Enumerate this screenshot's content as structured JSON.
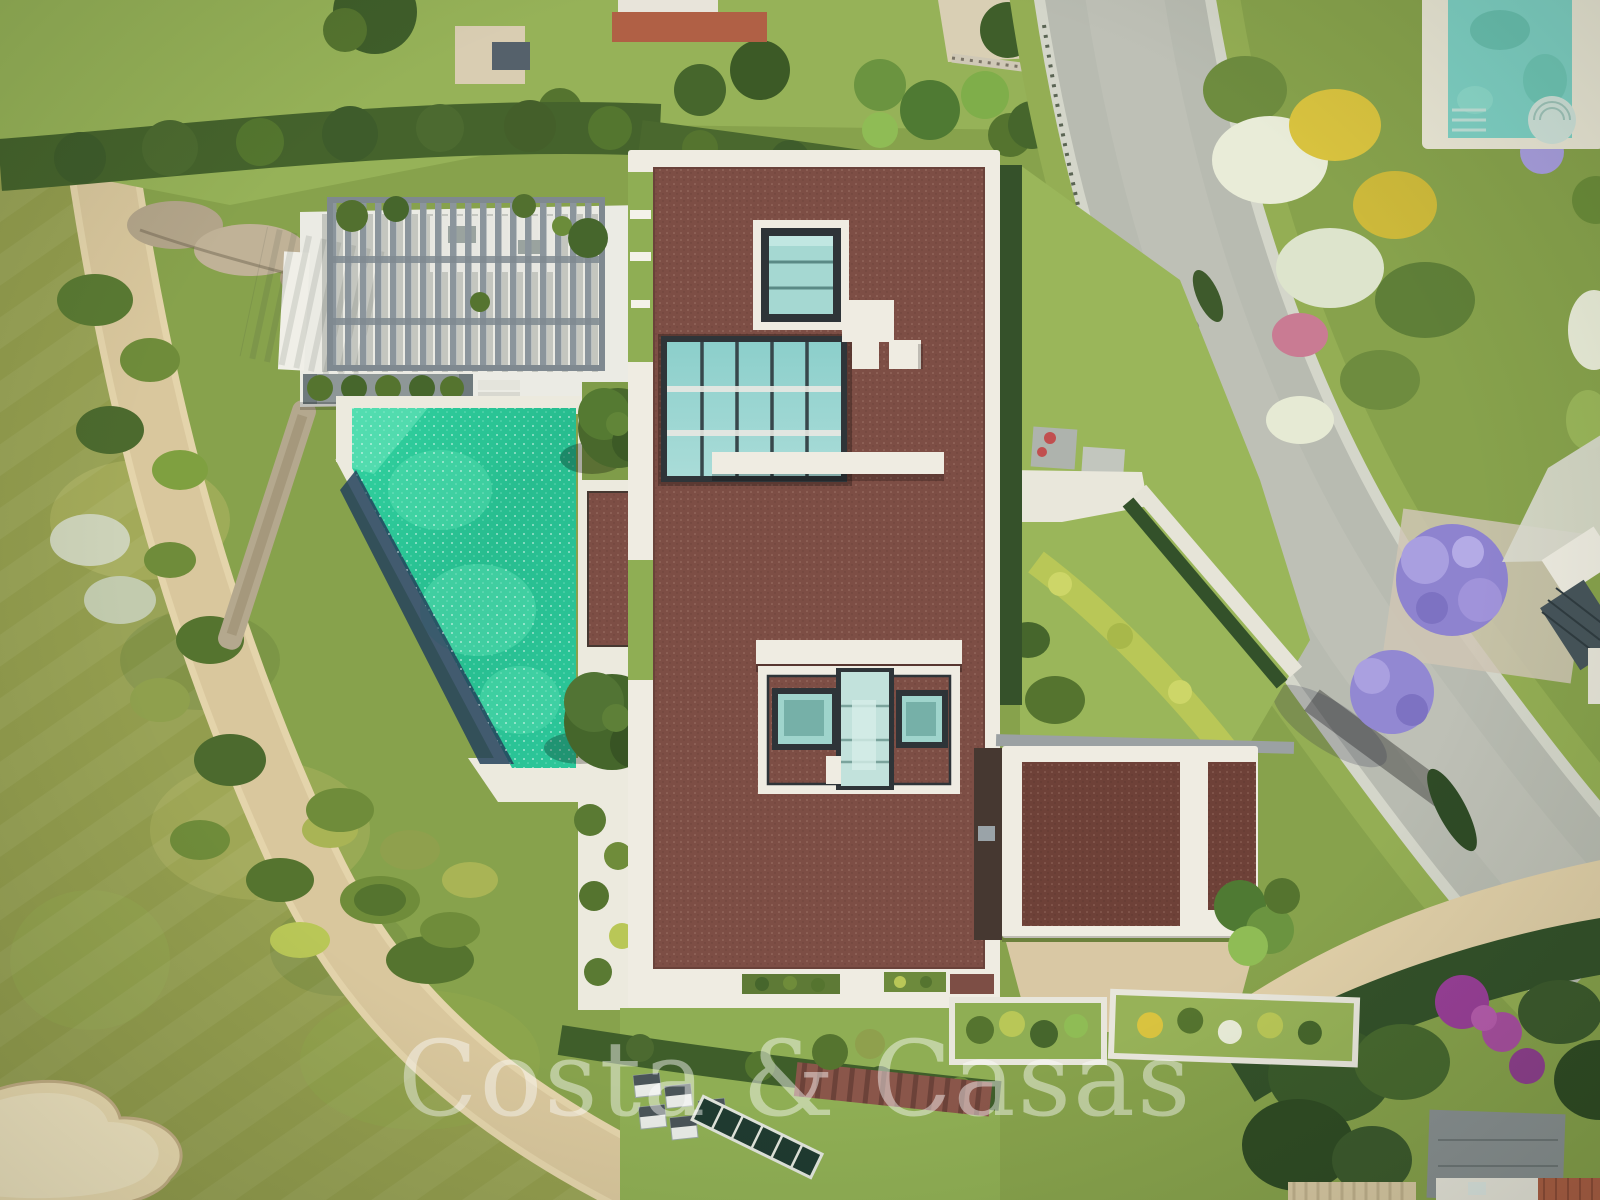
{
  "watermark": {
    "text": "Costa & Casas"
  },
  "scene": {
    "type": "aerial-drone-photograph",
    "subject": "top-down view of a modern flat-roof luxury villa with emerald pool, slatted pergola, golf-course fairway with sand bunker on the left, curved residential road with lush flower gardens on the right, neighbouring pool top-right and terracotta-roof house bottom-right"
  },
  "palette": {
    "roof": "#7d4e45",
    "roofDark": "#6e4138",
    "trim": "#efece2",
    "poolEmerald": "#28c496",
    "poolDeep": "#25425c",
    "glassTeal": "#a5d8d2",
    "atriumGlass": "#7fc6c4",
    "road": "#b8bbb1",
    "curb": "#d4d6ca",
    "fairway": "#939d4e",
    "lawn": "#8fae54",
    "hedgeDark": "#42602c",
    "hedgeYellow": "#b4c253",
    "sand": "#ecdcb2",
    "sandPath": "#d9c79d",
    "neighborPool": "#7ed0c4",
    "terracotta": "#b06045",
    "pergolaGray": "#8b959c",
    "watermark": "rgba(255,255,255,0.45)"
  }
}
